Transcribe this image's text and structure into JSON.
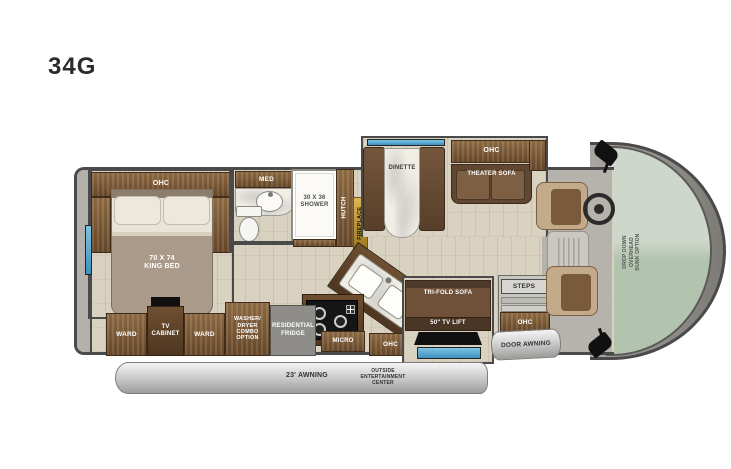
{
  "model": "34G",
  "bedroom": {
    "ohc": "OHC",
    "bed_size": "70 X 74",
    "bed_type": "KING BED",
    "ward_rear": "WARD",
    "tv_cabinet": "TV CABINET",
    "ward_front": "WARD"
  },
  "bathroom": {
    "med_cabinet": "MED",
    "shower": "30 X 36 SHOWER",
    "hutch": "HUTCH"
  },
  "kitchen": {
    "washer_dryer": "WASHER/ DRYER COMBO OPTION",
    "fridge": "RESIDENTIAL FRIDGE",
    "micro": "MICRO",
    "ohc": "OHC"
  },
  "living": {
    "fireplace": "FIREPLACE",
    "dinette": "DINETTE",
    "ohc": "OHC",
    "theater_sofa": "THEATER SOFA",
    "trifold_sofa": "TRI-FOLD SOFA",
    "tv_lift": "50\" TV LIFT"
  },
  "entry": {
    "steps": "STEPS",
    "ohc": "OHC",
    "door_awning": "DOOR AWNING"
  },
  "exterior": {
    "patio_awning": "23' AWNING",
    "outside_entertainment": "OUTSIDE ENTERTAINMENT CENTER"
  },
  "cab": {
    "overhead_bunk": "DROP DOWN OVERHEAD BUNK OPTION"
  },
  "colors": {
    "outline": "#4a4a4a",
    "floor": "#d9d2c1",
    "wood": "#7b5b39",
    "wood_dark": "#4e3a27",
    "sofa_brown": "#5f4732",
    "window_blue": "#4da1cf",
    "awning_silver": "#c6c6c6",
    "flame_gold": "#c9a227",
    "windshield_green": "#c2cfbf"
  }
}
